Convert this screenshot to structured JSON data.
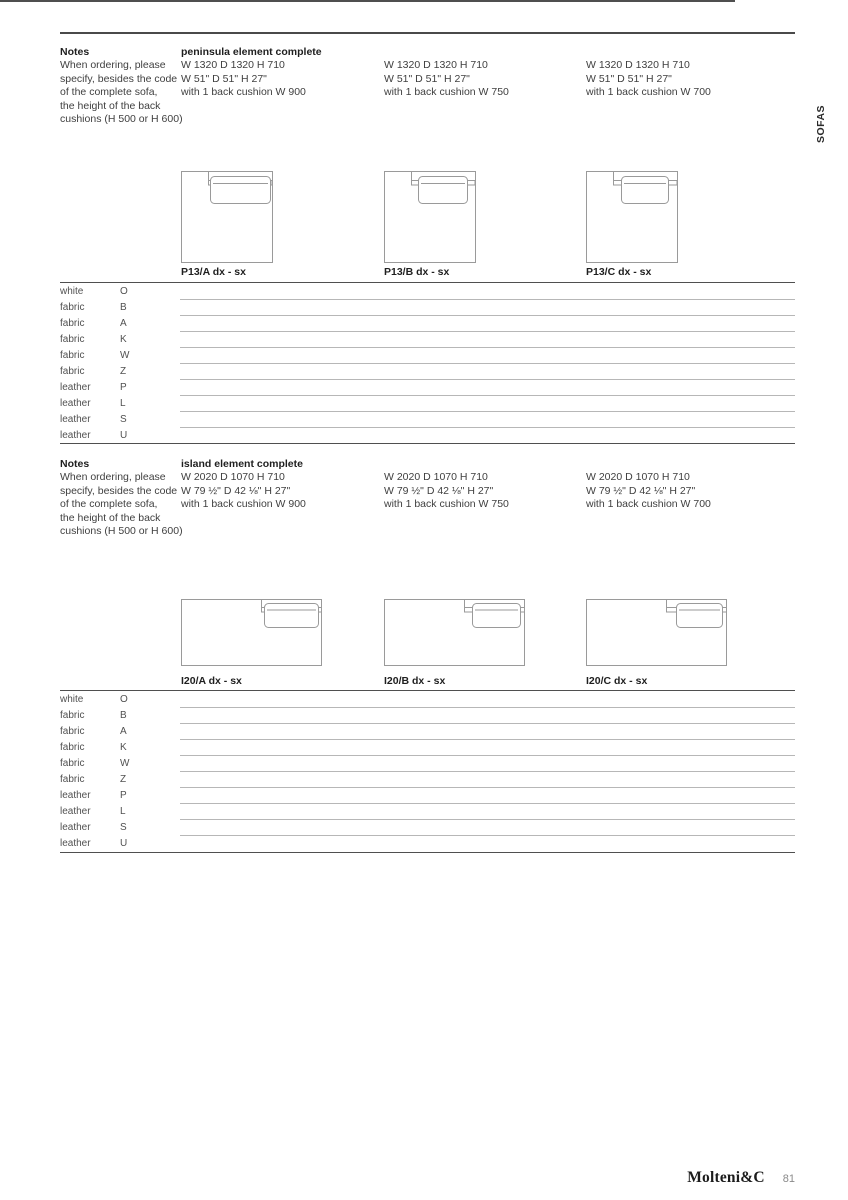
{
  "page": {
    "side_tab": "SOFAS",
    "footer": {
      "brand": "Molteni&C",
      "page_number": "81"
    }
  },
  "sections": [
    {
      "notes_title": "Notes",
      "notes_lines": [
        "When ordering, please",
        "specify, besides the code",
        "of the complete sofa,",
        "the height of the back",
        "cushions (H 500 or H 600)"
      ],
      "heading": "peninsula element complete",
      "variants": [
        {
          "dim_mm": "W 1320 D 1320 H 710",
          "dim_in": "W 51\" D 51\" H 27\"",
          "cushion": "with 1 back cushion W 900",
          "code": "P13/A dx - sx"
        },
        {
          "dim_mm": "W 1320 D 1320 H 710",
          "dim_in": "W 51\" D 51\" H 27\"",
          "cushion": "with 1 back cushion W 750",
          "code": "P13/B dx - sx"
        },
        {
          "dim_mm": "W 1320 D 1320 H 710",
          "dim_in": "W 51\" D 51\" H 27\"",
          "cushion": "with 1 back cushion W 700",
          "code": "P13/C dx - sx"
        }
      ],
      "price_rows": [
        {
          "material": "white",
          "code": "O"
        },
        {
          "material": "fabric",
          "code": "B"
        },
        {
          "material": "fabric",
          "code": "A"
        },
        {
          "material": "fabric",
          "code": "K"
        },
        {
          "material": "fabric",
          "code": "W"
        },
        {
          "material": "fabric",
          "code": "Z"
        },
        {
          "material": "leather",
          "code": "P"
        },
        {
          "material": "leather",
          "code": "L"
        },
        {
          "material": "leather",
          "code": "S"
        },
        {
          "material": "leather",
          "code": "U"
        }
      ]
    },
    {
      "notes_title": "Notes",
      "notes_lines": [
        "When ordering, please",
        "specify, besides the code",
        "of the complete sofa,",
        "the height of the back",
        "cushions (H 500 or H 600)"
      ],
      "heading": "island element complete",
      "variants": [
        {
          "dim_mm": "W 2020 D 1070 H 710",
          "dim_in": "W 79 ½\" D 42 ⅛\" H 27\"",
          "cushion": "with 1 back cushion W 900",
          "code": "I20/A dx - sx"
        },
        {
          "dim_mm": "W 2020 D 1070 H 710",
          "dim_in": "W 79 ½\" D 42 ⅛\" H 27\"",
          "cushion": "with 1 back cushion W 750",
          "code": "I20/B dx - sx"
        },
        {
          "dim_mm": "W 2020 D 1070 H 710",
          "dim_in": "W 79 ½\" D 42 ⅛\" H 27\"",
          "cushion": "with 1 back cushion W 700",
          "code": "I20/C dx - sx"
        }
      ],
      "price_rows": [
        {
          "material": "white",
          "code": "O"
        },
        {
          "material": "fabric",
          "code": "B"
        },
        {
          "material": "fabric",
          "code": "A"
        },
        {
          "material": "fabric",
          "code": "K"
        },
        {
          "material": "fabric",
          "code": "W"
        },
        {
          "material": "fabric",
          "code": "Z"
        },
        {
          "material": "leather",
          "code": "P"
        },
        {
          "material": "leather",
          "code": "L"
        },
        {
          "material": "leather",
          "code": "S"
        },
        {
          "material": "leather",
          "code": "U"
        }
      ]
    }
  ]
}
